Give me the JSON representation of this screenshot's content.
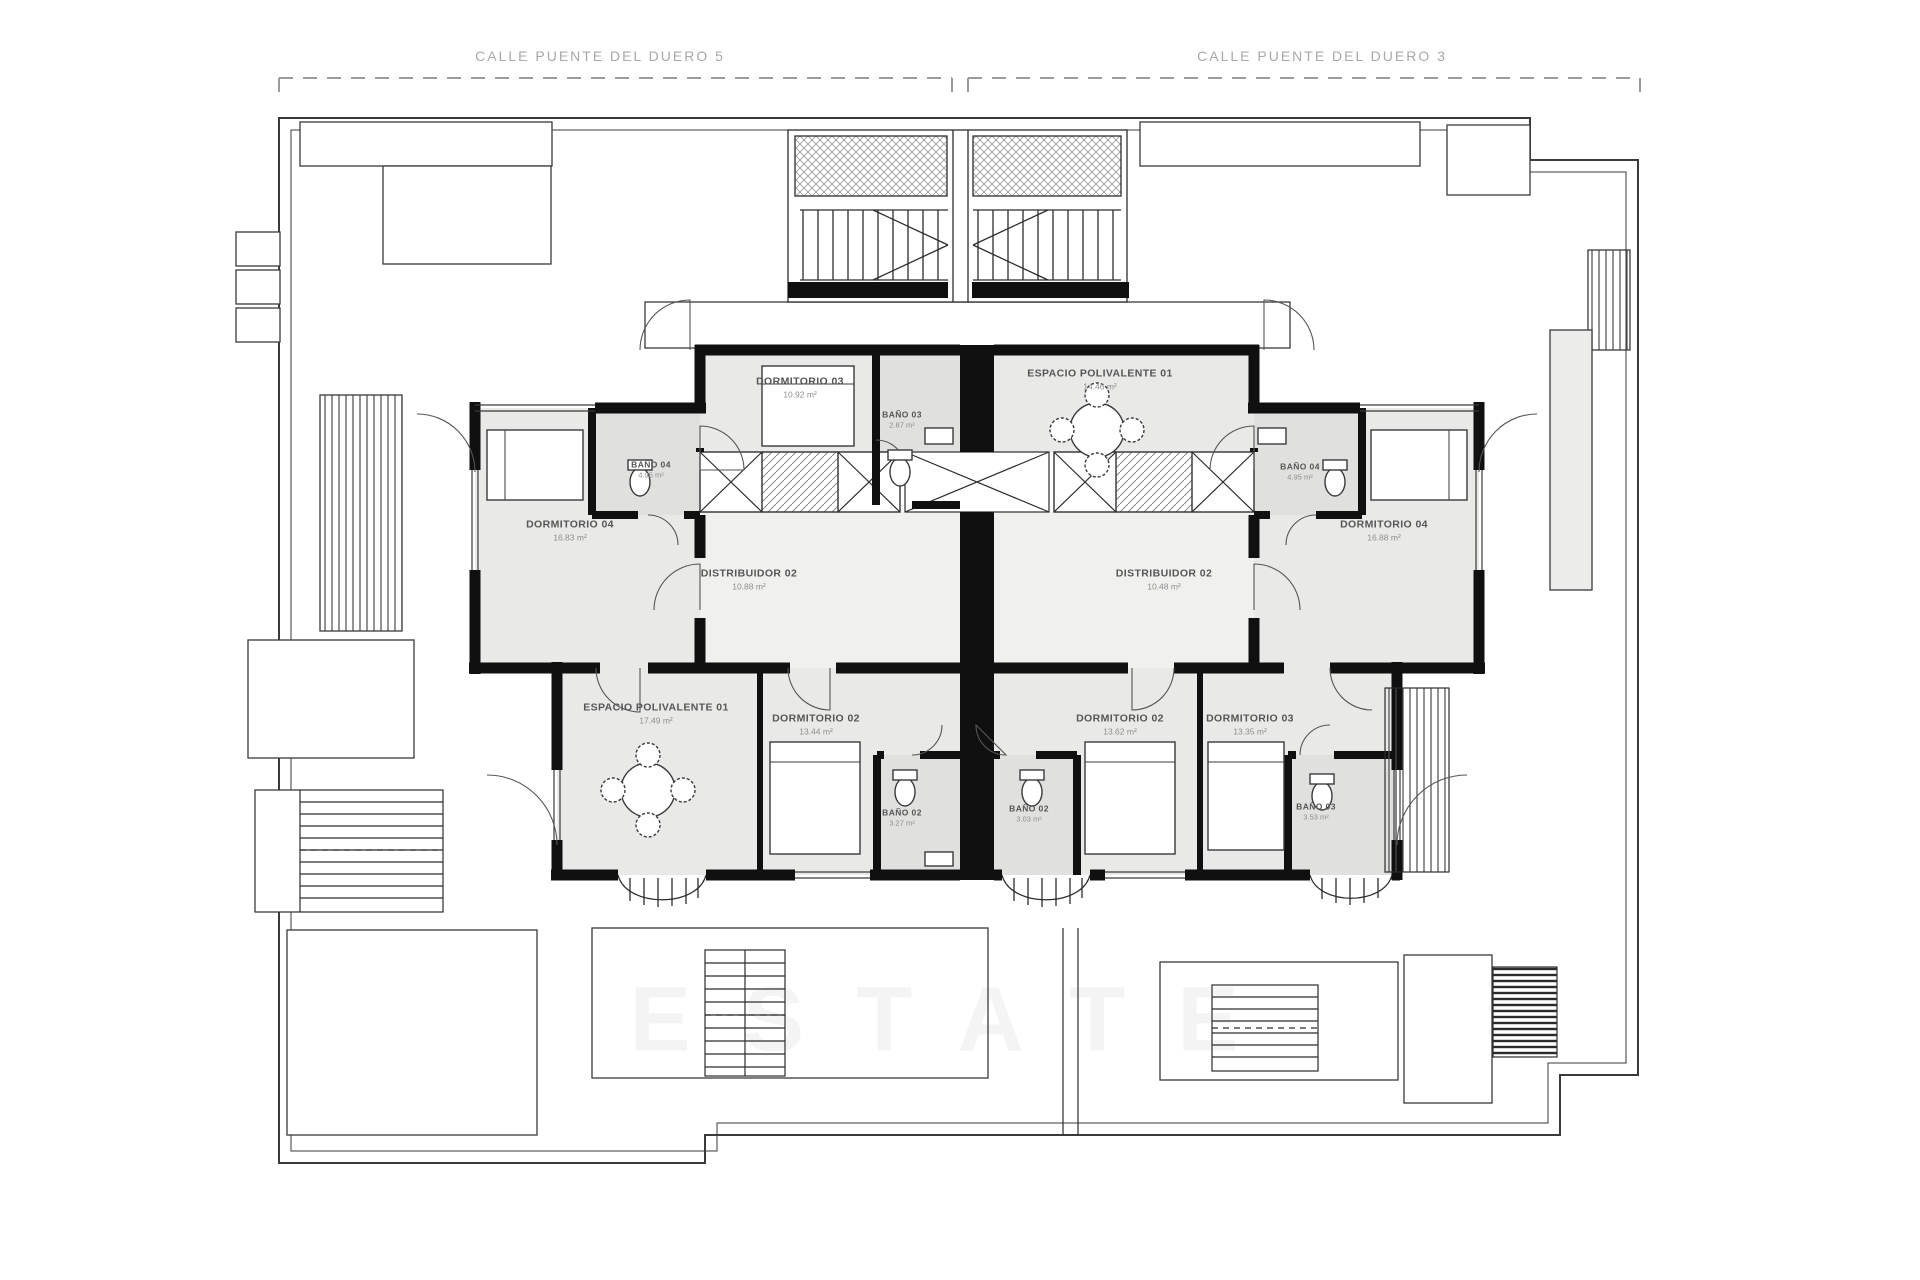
{
  "streets": [
    {
      "label": "CALLE PUENTE DEL DUERO 5"
    },
    {
      "label": "CALLE PUENTE DEL DUERO 3"
    }
  ],
  "watermark": {
    "text": "ESTATE"
  },
  "rooms": [
    {
      "name": "DORMITORIO 03",
      "area": "10.92 m²"
    },
    {
      "name": "BAÑO 03",
      "area": "2.87 m²"
    },
    {
      "name": "BAÑO 04",
      "area": "4.95 m²"
    },
    {
      "name": "DORMITORIO 04",
      "area": "16.83 m²"
    },
    {
      "name": "DISTRIBUIDOR 02",
      "area": "10.88 m²"
    },
    {
      "name": "ESPACIO POLIVALENTE 01",
      "area": "17.49 m²"
    },
    {
      "name": "DORMITORIO 02",
      "area": "13.44 m²"
    },
    {
      "name": "BAÑO 02",
      "area": "3.27 m²"
    },
    {
      "name": "ESPACIO POLIVALENTE 01",
      "area": "14.46 m²"
    },
    {
      "name": "BAÑO 04",
      "area": "4.95 m²"
    },
    {
      "name": "DORMITORIO 04",
      "area": "16.88 m²"
    },
    {
      "name": "DISTRIBUIDOR 02",
      "area": "10.48 m²"
    },
    {
      "name": "BAÑO 02",
      "area": "3.03 m²"
    },
    {
      "name": "DORMITORIO 02",
      "area": "13.62 m²"
    },
    {
      "name": "DORMITORIO 03",
      "area": "13.35 m²"
    },
    {
      "name": "BAÑO 03",
      "area": "3.53 m²"
    }
  ],
  "colors": {
    "wall": "#101010",
    "room_fill": "#e9e9e8",
    "bath_fill": "#e0e0df",
    "hall_fill": "#f0f0ef",
    "line": "#3a3a3a",
    "dashed_boundary": "#9b9b9b"
  }
}
